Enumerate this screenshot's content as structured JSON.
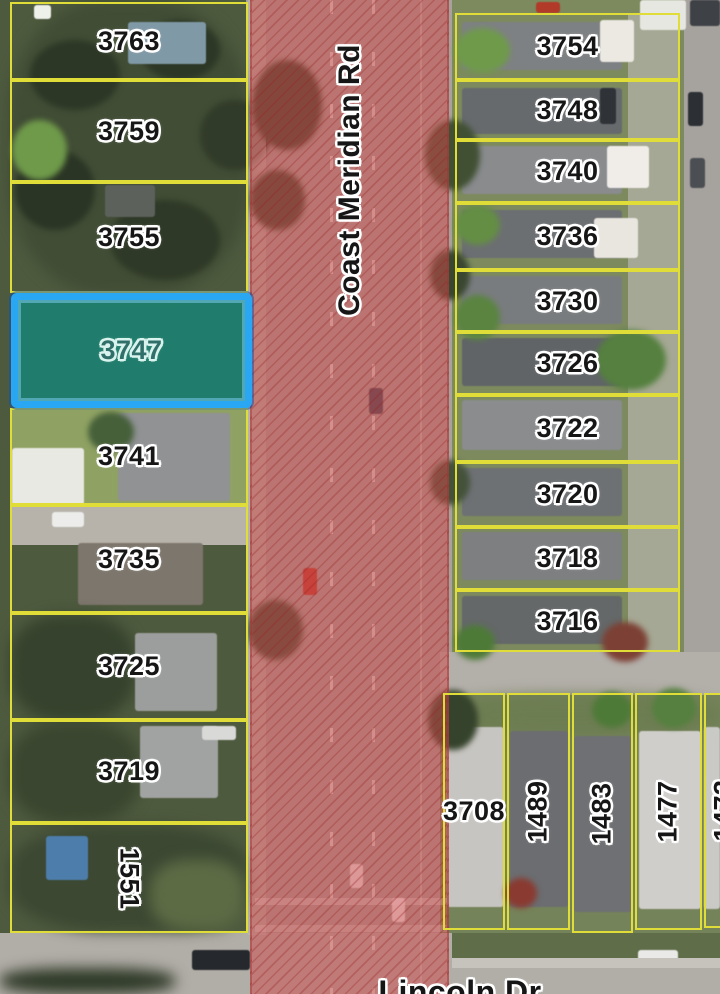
{
  "map": {
    "type": "aerial-parcel-map",
    "road_label": "Coast Meridian Rd",
    "cross_street_label": "Lincoln Dr",
    "highlighted_parcel": {
      "label": "3747"
    },
    "west_parcels": [
      {
        "label": "3763"
      },
      {
        "label": "3759"
      },
      {
        "label": "3755"
      },
      {
        "label": "3741"
      },
      {
        "label": "3735"
      },
      {
        "label": "3725"
      },
      {
        "label": "3719"
      },
      {
        "label": "1551"
      }
    ],
    "east_parcels": [
      {
        "label": "3754"
      },
      {
        "label": "3748"
      },
      {
        "label": "3740"
      },
      {
        "label": "3736"
      },
      {
        "label": "3730"
      },
      {
        "label": "3726"
      },
      {
        "label": "3722"
      },
      {
        "label": "3720"
      },
      {
        "label": "3718"
      },
      {
        "label": "3716"
      }
    ],
    "southeast_parcels": [
      {
        "label": "3708"
      },
      {
        "label": "1489"
      },
      {
        "label": "1483"
      },
      {
        "label": "1477"
      },
      {
        "label": "1473"
      }
    ],
    "colors": {
      "parcel_line": "#e0dc38",
      "highlight_border": "#2aa7f3",
      "highlight_fill_teal": "#00968e",
      "road_overlay_red": "#cd4b4b",
      "label_text": "#161616",
      "label_halo": "#ffffff"
    }
  }
}
